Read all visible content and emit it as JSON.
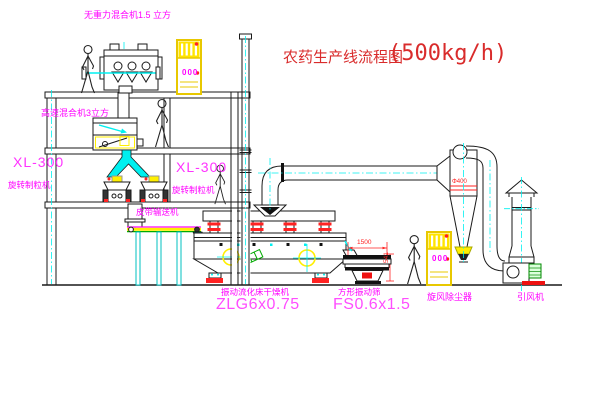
{
  "drawing": {
    "title": "农药生产线流程图",
    "capacity": "(500kg/h)"
  },
  "labels": {
    "gravity_mixer": "无重力混合机1.5 立方",
    "high_speed_mixer": "高速混合机3立方",
    "granulator_left_model": "XL-300",
    "granulator_left_name": "旋转制粒机",
    "granulator_mid_model": "XL-300",
    "granulator_mid_name": "旋转制粒机",
    "belt_conveyor": "皮带输送机",
    "fluid_bed_dryer_name": "振动流化床干燥机",
    "fluid_bed_dryer_model": "ZLG6x0.75",
    "vibrating_screen_name": "方形振动筛",
    "vibrating_screen_model": "FS0.6x1.5",
    "cyclone_name": "旋风除尘器",
    "fan_name": "引风机"
  },
  "dimensions": {
    "screen_length": "1500",
    "screen_height": "541",
    "cyclone_marking": "Φ400"
  },
  "cabinets": {
    "cabinet1_display": "000",
    "cabinet2_display": "000"
  },
  "colors": {
    "label_magenta": "#ff00ff",
    "model_pink": "#ff4dff",
    "title_red": "#d92b2b",
    "dimension_red": "#ff2222",
    "centerline_cyan": "#00f0f0",
    "machine_yellow": "#ffef00",
    "belt_green": "#00aa00"
  }
}
